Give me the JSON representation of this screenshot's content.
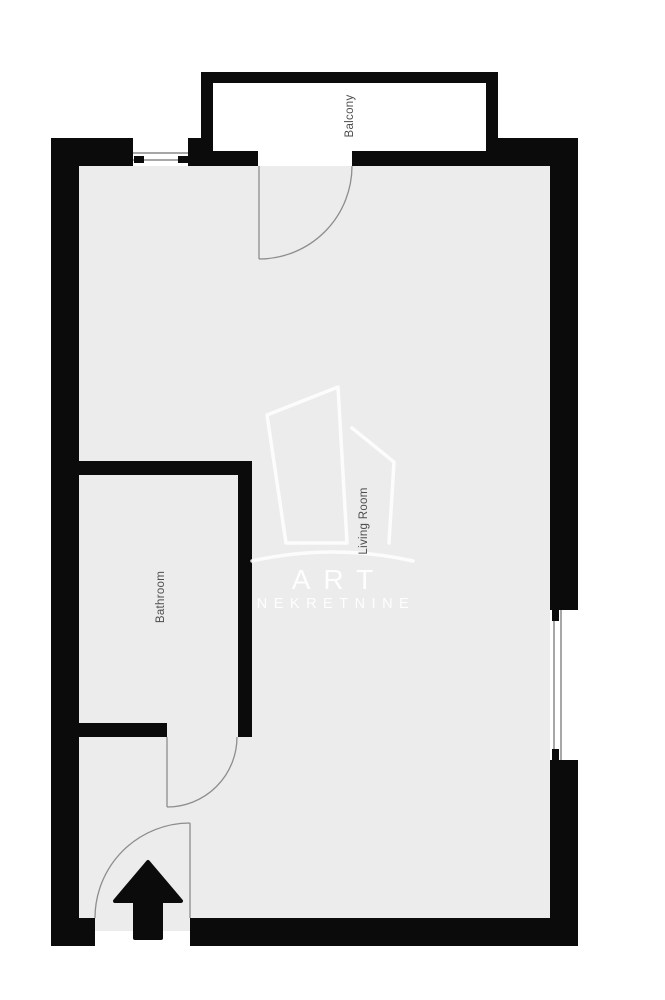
{
  "rooms": [
    {
      "id": "balcony",
      "label": "Balcony"
    },
    {
      "id": "living-room",
      "label": "Living Room"
    },
    {
      "id": "bathroom",
      "label": "Bathroom"
    }
  ],
  "watermark": {
    "line1": "ART",
    "line2": "NEKRETNINE"
  },
  "icons": {
    "entrance_arrow": "up-arrow"
  },
  "colors": {
    "wall": "#0b0b0b",
    "floor": "#ececec",
    "balcony_floor": "#ffffff",
    "background": "#ffffff",
    "door_swing": "#8d8d8d",
    "window_line": "#4f4f4f",
    "room_label": "#4d4d4d",
    "watermark_text": "#ffffff"
  }
}
